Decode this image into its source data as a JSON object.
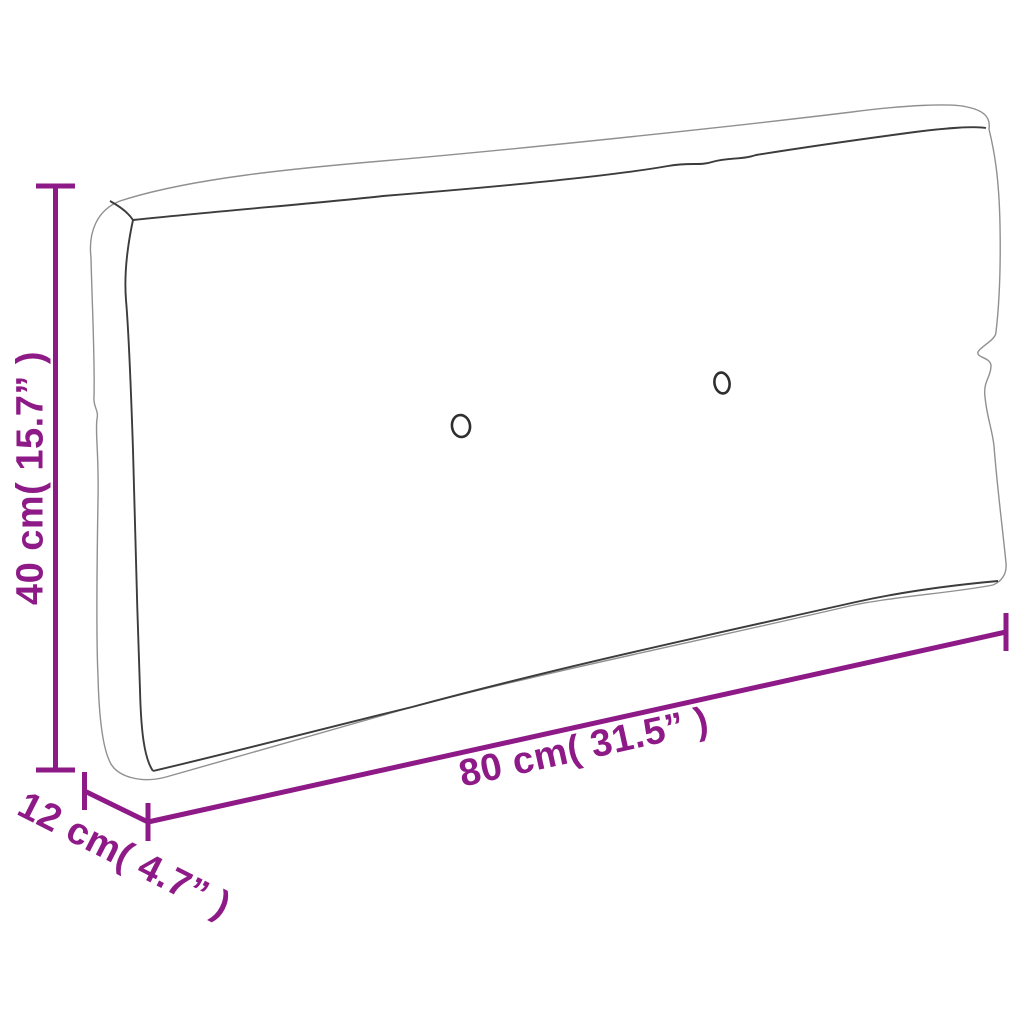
{
  "diagram": {
    "dimensions": {
      "height": {
        "value_cm": 40,
        "value_in": 15.7,
        "label": "40 cm( 15.7” )"
      },
      "depth": {
        "value_cm": 12,
        "value_in": 4.7,
        "label": "12 cm( 4.7” )"
      },
      "width": {
        "value_cm": 80,
        "value_in": 31.5,
        "label": "80 cm( 31.5” )"
      }
    },
    "cushion": {
      "button_count": 2
    },
    "colors": {
      "accent": "#8E1A87",
      "outline_light": "#909090",
      "outline_dark": "#3c3c3c",
      "background": "#ffffff"
    }
  }
}
